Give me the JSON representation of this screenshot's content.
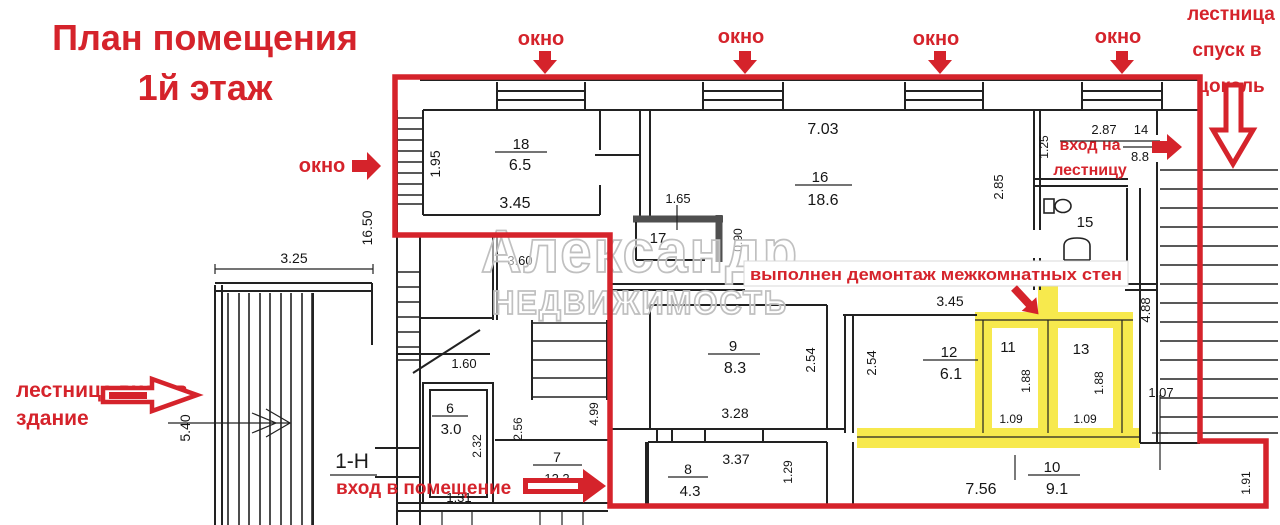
{
  "title": [
    "План помещения",
    "1й этаж"
  ],
  "watermark": [
    "Александр",
    "НЕДВИЖИМОСТЬ"
  ],
  "demolition_note": "выполнен демонтаж межкомнатных стен",
  "unit": "1-Н",
  "callouts": {
    "window": "окно",
    "basement": [
      "лестница",
      "спуск в",
      "цоколь"
    ],
    "building_entrance": [
      "лестница вход в",
      "здание"
    ],
    "stairs_entrance": [
      "вход на",
      "лестницу"
    ],
    "premises_entrance": "вход в помещение"
  },
  "colors": {
    "red": "#d5232b",
    "yellow": "#f7e94d",
    "wall": "#222222",
    "gray_wall": "#4f4f4f",
    "watermark": "#c0c0c0"
  },
  "dim_labels": [
    {
      "t": "1.95",
      "x": 440,
      "y": 164,
      "r": -90,
      "s": 14
    },
    {
      "t": "18",
      "x": 521,
      "y": 149,
      "s": 15
    },
    {
      "t": "6.5",
      "x": 520,
      "y": 170,
      "s": 16
    },
    {
      "t": "3.45",
      "x": 515,
      "y": 208,
      "s": 16
    },
    {
      "t": "16.50",
      "x": 372,
      "y": 228,
      "r": -90,
      "s": 14
    },
    {
      "t": "3.25",
      "x": 294,
      "y": 263,
      "s": 14
    },
    {
      "t": "5.40",
      "x": 190,
      "y": 428,
      "r": -90,
      "s": 14
    },
    {
      "t": "7.03",
      "x": 823,
      "y": 134,
      "s": 16
    },
    {
      "t": "16",
      "x": 820,
      "y": 182,
      "s": 15
    },
    {
      "t": "18.6",
      "x": 823,
      "y": 205,
      "s": 16
    },
    {
      "t": "2.85",
      "x": 1003,
      "y": 187,
      "r": -90,
      "s": 13
    },
    {
      "t": "1.65",
      "x": 678,
      "y": 203,
      "s": 13
    },
    {
      "t": "17",
      "x": 658,
      "y": 243,
      "s": 15
    },
    {
      "t": "0.90",
      "x": 742,
      "y": 240,
      "r": -90,
      "s": 12
    },
    {
      "t": "1.25",
      "x": 1048,
      "y": 147,
      "r": -90,
      "s": 12
    },
    {
      "t": "2.87",
      "x": 1104,
      "y": 134,
      "s": 13
    },
    {
      "t": "14",
      "x": 1141,
      "y": 134,
      "s": 13
    },
    {
      "t": "8.8",
      "x": 1140,
      "y": 161,
      "s": 13
    },
    {
      "t": "15",
      "x": 1085,
      "y": 227,
      "s": 15
    },
    {
      "t": "3.45",
      "x": 950,
      "y": 306,
      "s": 14
    },
    {
      "t": "2.54",
      "x": 815,
      "y": 360,
      "r": -90,
      "s": 13
    },
    {
      "t": "2.54",
      "x": 876,
      "y": 363,
      "r": -90,
      "s": 13
    },
    {
      "t": "9",
      "x": 733,
      "y": 351,
      "s": 15
    },
    {
      "t": "8.3",
      "x": 735,
      "y": 373,
      "s": 16
    },
    {
      "t": "3.28",
      "x": 735,
      "y": 418,
      "s": 14
    },
    {
      "t": "12",
      "x": 949,
      "y": 357,
      "s": 15
    },
    {
      "t": "6.1",
      "x": 951,
      "y": 379,
      "s": 16
    },
    {
      "t": "11",
      "x": 1008,
      "y": 352,
      "s": 15
    },
    {
      "t": "1.88",
      "x": 1030,
      "y": 381,
      "r": -90,
      "s": 12
    },
    {
      "t": "1.09",
      "x": 1011,
      "y": 423,
      "s": 12
    },
    {
      "t": "13",
      "x": 1081,
      "y": 354,
      "s": 15
    },
    {
      "t": "1.88",
      "x": 1103,
      "y": 383,
      "r": -90,
      "s": 12
    },
    {
      "t": "1.09",
      "x": 1085,
      "y": 423,
      "s": 12
    },
    {
      "t": "4.88",
      "x": 1150,
      "y": 310,
      "r": -90,
      "s": 13
    },
    {
      "t": "1.07",
      "x": 1161,
      "y": 397,
      "s": 13
    },
    {
      "t": "1.91",
      "x": 1250,
      "y": 483,
      "r": -90,
      "s": 12
    },
    {
      "t": "3.60",
      "x": 520,
      "y": 265,
      "s": 13
    },
    {
      "t": "1.60",
      "x": 464,
      "y": 368,
      "s": 13
    },
    {
      "t": "6",
      "x": 450,
      "y": 413,
      "s": 14
    },
    {
      "t": "3.0",
      "x": 451,
      "y": 434,
      "s": 15
    },
    {
      "t": "2.32",
      "x": 481,
      "y": 446,
      "r": -90,
      "s": 12
    },
    {
      "t": "2.56",
      "x": 522,
      "y": 429,
      "r": -90,
      "s": 12
    },
    {
      "t": "1.31",
      "x": 459,
      "y": 502,
      "s": 13
    },
    {
      "t": "7",
      "x": 557,
      "y": 462,
      "s": 14
    },
    {
      "t": "12.2",
      "x": 557,
      "y": 483,
      "s": 13
    },
    {
      "t": "4.99",
      "x": 598,
      "y": 414,
      "r": -90,
      "s": 12
    },
    {
      "t": "8",
      "x": 688,
      "y": 474,
      "s": 14
    },
    {
      "t": "4.3",
      "x": 690,
      "y": 496,
      "s": 15
    },
    {
      "t": "3.37",
      "x": 736,
      "y": 464,
      "s": 14
    },
    {
      "t": "1.29",
      "x": 792,
      "y": 472,
      "r": -90,
      "s": 12
    },
    {
      "t": "7.56",
      "x": 981,
      "y": 494,
      "s": 16
    },
    {
      "t": "10",
      "x": 1052,
      "y": 472,
      "s": 15
    },
    {
      "t": "9.1",
      "x": 1057,
      "y": 494,
      "s": 16
    }
  ]
}
